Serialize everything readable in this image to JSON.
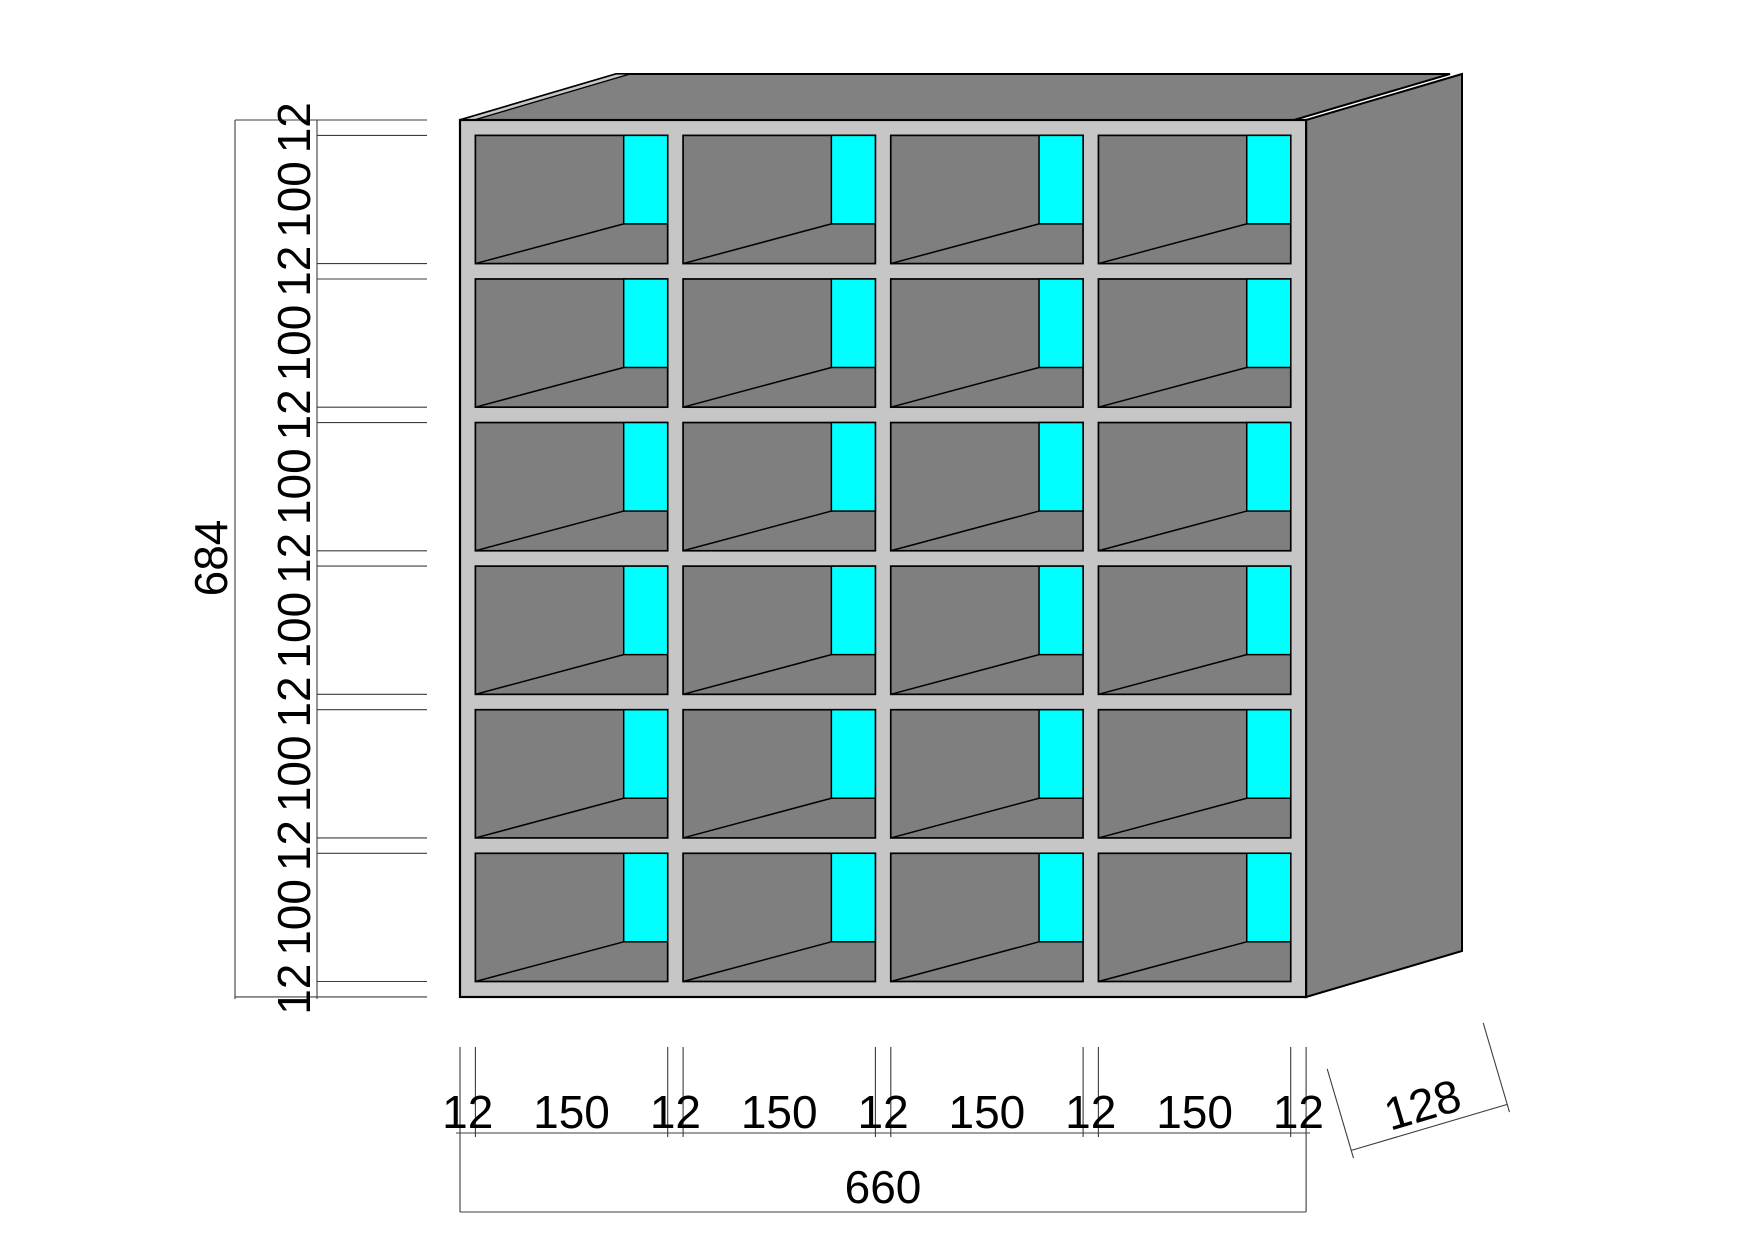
{
  "drawing": {
    "background": "#ffffff",
    "line_color": "#3c3c3c",
    "outline_color": "#000000"
  },
  "cabinet": {
    "rows": 6,
    "columns": 4,
    "colors": {
      "frame": "#c6c6c6",
      "interior": "#7f7f7f",
      "top_face": "#818181",
      "side_panel": "#818181",
      "edge_sliver": "#c6c6c6",
      "highlight": "#00ffff"
    }
  },
  "dimensions": {
    "height_chain": {
      "labels": [
        "12",
        "100",
        "12",
        "100",
        "12",
        "100",
        "12",
        "100",
        "12",
        "100",
        "12",
        "100",
        "12"
      ],
      "total": "684"
    },
    "width_chain": {
      "labels": [
        "12",
        "150",
        "12",
        "150",
        "12",
        "150",
        "12",
        "150",
        "12"
      ],
      "total": "660"
    },
    "depth": {
      "label": "128"
    }
  }
}
